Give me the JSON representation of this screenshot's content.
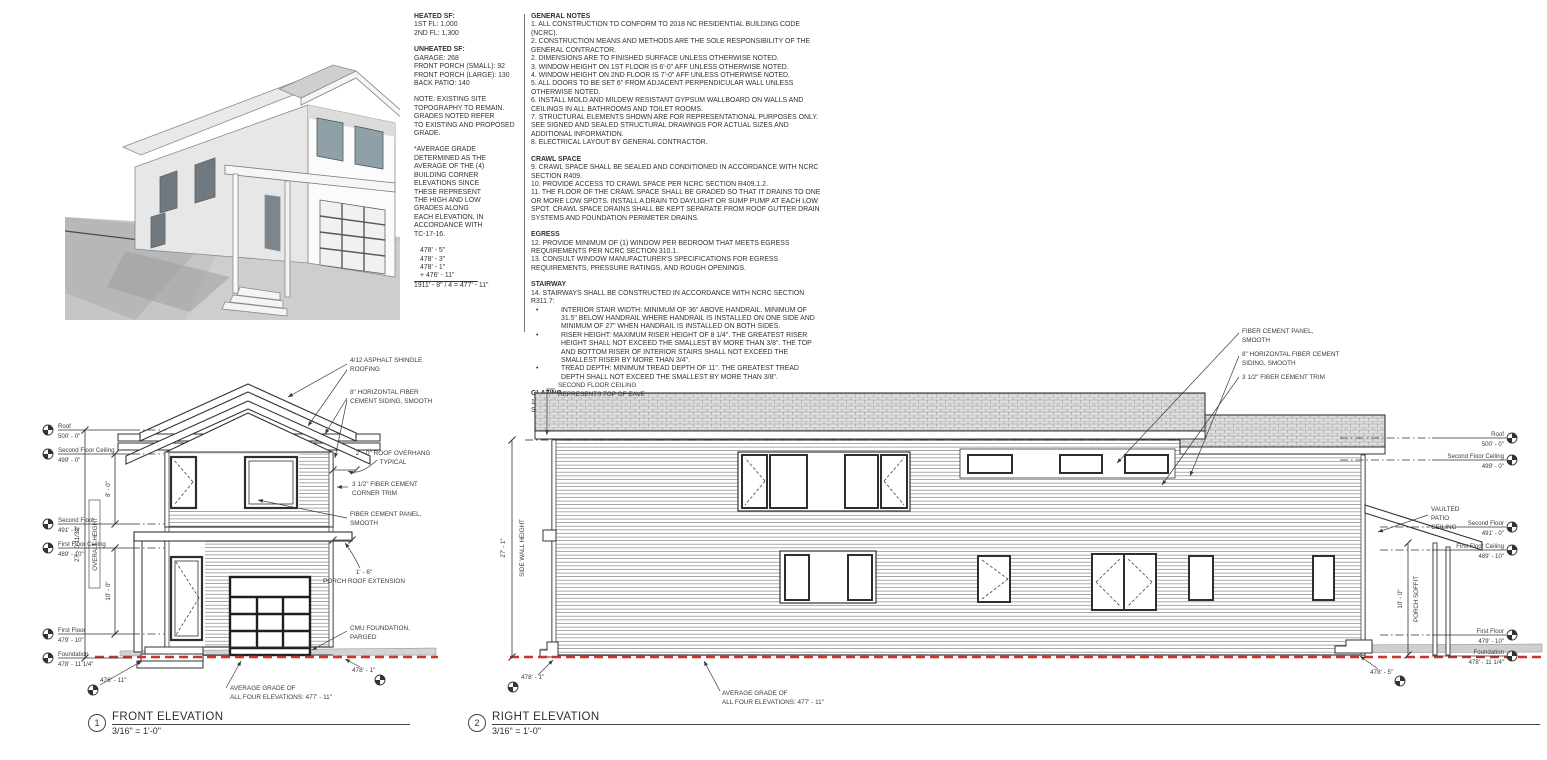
{
  "colors": {
    "ink": "#3a3a3a",
    "grade_red": "#c9342b",
    "roof_gray": "#dedede"
  },
  "summary": {
    "heated_title": "HEATED SF:",
    "heated": [
      "1ST FL: 1,000",
      "2ND FL: 1,300"
    ],
    "unheated_title": "UNHEATED SF:",
    "unheated": [
      "GARAGE: 268",
      "FRONT PORCH (SMALL): 92",
      "FRONT PORCH (LARGE): 130",
      "BACK PATIO: 140"
    ],
    "site_note": [
      "NOTE: EXISTING SITE",
      "TOPOGRAPHY TO REMAIN.",
      "GRADES NOTED REFER",
      "TO EXISTING AND PROPOSED",
      "GRADE."
    ],
    "avg_note": [
      "*AVERAGE GRADE",
      "DETERMINED AS THE",
      "AVERAGE OF THE (4)",
      "BUILDING CORNER",
      "ELEVATIONS SINCE",
      "THESE REPRESENT",
      "THE HIGH AND LOW",
      "GRADES ALONG",
      "EACH ELEVATION, IN",
      "ACCORDANCE WITH",
      "TC-17-16."
    ],
    "grade_addends": [
      "478' -  5\"",
      "478' -  3\"",
      "478' -  1\"",
      "+ 476' - 11\""
    ],
    "grade_result": "1911' -  8\" / 4 = 477' - 11\""
  },
  "notes": {
    "bullet": "•",
    "sections": [
      {
        "heading": "GENERAL NOTES",
        "items": [
          "1. ALL CONSTRUCTION TO CONFORM TO 2018 NC RESIDENTIAL BUILDING CODE (NCRC).",
          "2. CONSTRUCTION MEANS AND METHODS ARE THE SOLE RESPONSIBILITY OF THE GENERAL CONTRACTOR.",
          "2. DIMENSIONS ARE TO FINISHED SURFACE UNLESS OTHERWISE NOTED.",
          "3. WINDOW HEIGHT ON 1ST FLOOR IS 6'-0\" AFF UNLESS OTHERWISE NOTED.",
          "4. WINDOW HEIGHT ON 2ND FLOOR IS 7'-0\" AFF UNLESS OTHERWISE NOTED.",
          "5. ALL DOORS TO BE SET 6\" FROM ADJACENT PERPENDICULAR WALL UNLESS OTHERWISE NOTED.",
          "6. INSTALL MOLD AND MILDEW RESISTANT GYPSUM WALLBOARD ON WALLS AND CEILINGS IN ALL BATHROOMS AND TOILET ROOMS.",
          "7. STRUCTURAL ELEMENTS SHOWN ARE FOR REPRESENTATIONAL PURPOSES ONLY. SEE SIGNED AND SEALED STRUCTURAL DRAWINGS FOR ACTUAL SIZES AND ADDITIONAL INFORMATION.",
          "8. ELECTRICAL LAYOUT BY GENERAL CONTRACTOR."
        ]
      },
      {
        "heading": "CRAWL SPACE",
        "items": [
          "9. CRAWL SPACE SHALL BE SEALED AND CONDITIONED IN ACCORDANCE WITH NCRC SECTION R409.",
          "10. PROVIDE ACCESS TO CRAWL SPACE PER NCRC SECTION R409.1.2.",
          "11. THE FLOOR OF THE CRAWL SPACE SHALL BE GRADED SO THAT IT DRAINS TO ONE OR MORE LOW SPOTS. INSTALL A DRAIN TO DAYLIGHT OR SUMP PUMP AT EACH LOW SPOT. CRAWL SPACE DRAINS SHALL BE KEPT SEPARATE FROM ROOF GUTTER DRAIN SYSTEMS AND FOUNDATION PERIMETER DRAINS."
        ]
      },
      {
        "heading": "EGRESS",
        "items": [
          "12. PROVIDE MINIMUM OF (1) WINDOW PER BEDROOM THAT MEETS EGRESS REQUIREMENTS PER NCRC SECTION 310.1.",
          "13. CONSULT WINDOW MANUFACTURER'S SPECIFICATIONS FOR EGRESS REQUIREMENTS, PRESSURE RATINGS, AND ROUGH OPENINGS."
        ]
      },
      {
        "heading": "STAIRWAY",
        "items": [
          "14. STAIRWAYS SHALL BE CONSTRUCTED IN ACCORDANCE WITH NCRC SECTION R311.7:"
        ],
        "bullets": [
          "INTERIOR STAIR WIDTH: MINIMUM OF 36\" ABOVE HANDRAIL. MINIMUM OF 31.5\" BELOW HANDRAIL WHERE HANDRAIL IS INSTALLED ON ONE SIDE AND MINIMUM OF 27\" WHEN HANDRAIL IS INSTALLED ON BOTH SIDES.",
          "RISER HEIGHT: MAXIMUM RISER HEIGHT OF 8 1/4\". THE GREATEST RISER HEIGHT SHALL NOT EXCEED THE SMALLEST BY MORE THAN 3/8\". THE TOP AND BOTTOM RISER OF INTERIOR STAIRS SHALL NOT EXCEED THE SMALLEST RISER BY MORE THAN 3/4\".",
          "TREAD DEPTH: MINIMUM TREAD DEPTH OF 11\". THE GREATEST TREAD DEPTH SHALL NOT EXCEED THE SMALLEST BY MORE THAN 3/8\"."
        ]
      },
      {
        "heading": "GLAZING",
        "items": [
          "15. PROVIDE TEMPERED GLAZING IN HAZARDOUS LOCATIONS AS DEFINED IN NCRC SECTION 308.4."
        ]
      }
    ]
  },
  "levels": [
    {
      "name": "Roof",
      "elev": "500' - 0\""
    },
    {
      "name": "Second Floor Ceiling",
      "elev": "499' - 0\""
    },
    {
      "name": "Second Floor",
      "elev": "491' - 0\""
    },
    {
      "name": "First Floor Ceiling",
      "elev": "489' - 10\""
    },
    {
      "name": "First Floor",
      "elev": "479' - 10\""
    },
    {
      "name": "Foundation",
      "elev": "478' - 11 1/4\""
    }
  ],
  "front": {
    "number": "1",
    "title": "FRONT ELEVATION",
    "scale": "3/16\" = 1'-0\"",
    "dims": {
      "overall": "27' - 0 11/32\"",
      "overall_label": "OVERALL HEIGHT",
      "upper": "8' - 0\"",
      "lower": "10' - 0\""
    },
    "callouts": {
      "roofing": [
        "4/12 ASPHALT SHINGLE",
        "ROOFING"
      ],
      "siding": [
        "8\" HORIZONTAL FIBER",
        "CEMENT SIDING, SMOOTH"
      ],
      "overhang": [
        "2' - 0\" ROOF OVERHANG",
        "TYPICAL"
      ],
      "corner_trim": [
        "3 1/2\" FIBER CEMENT",
        "CORNER TRIM"
      ],
      "panel": [
        "FIBER CEMENT PANEL,",
        "SMOOTH"
      ],
      "porch_ext": [
        "1' - 6\"",
        "PORCH ROOF EXTENSION"
      ],
      "cmu": [
        "CMU FOUNDATION,",
        "PARGED"
      ]
    },
    "grade_left": "476' - 11\"",
    "grade_right": "478' - 1\"",
    "avg_grade": [
      "AVERAGE GRADE OF",
      "ALL FOUR ELEVATIONS: 477' - 11\""
    ]
  },
  "right": {
    "number": "2",
    "title": "RIGHT ELEVATION",
    "scale": "3/16\" = 1'-0\"",
    "dims": {
      "wall": "27' - 1\"",
      "wall_label": "SIDE WALL HEIGHT",
      "porch": "10' - 0\"",
      "porch_label": "PORCH SOFFIT"
    },
    "callouts": {
      "eave": [
        "SECOND FLOOR CEILING",
        "REPRESENTS TOP OF EAVE"
      ],
      "panel": [
        "FIBER CEMENT PANEL,",
        "SMOOTH"
      ],
      "siding": [
        "8\" HORIZONTAL FIBER CEMENT",
        "SIDING, SMOOTH"
      ],
      "trim": [
        "3 1/2\" FIBER CEMENT TRIM"
      ],
      "patio": [
        "VAULTED",
        "PATIO",
        "CEILING"
      ]
    },
    "grade_left": "478' - 1\"",
    "grade_right": "478' - 5\"",
    "avg_grade": [
      "AVERAGE GRADE OF",
      "ALL FOUR ELEVATIONS: 477' - 11\""
    ]
  }
}
